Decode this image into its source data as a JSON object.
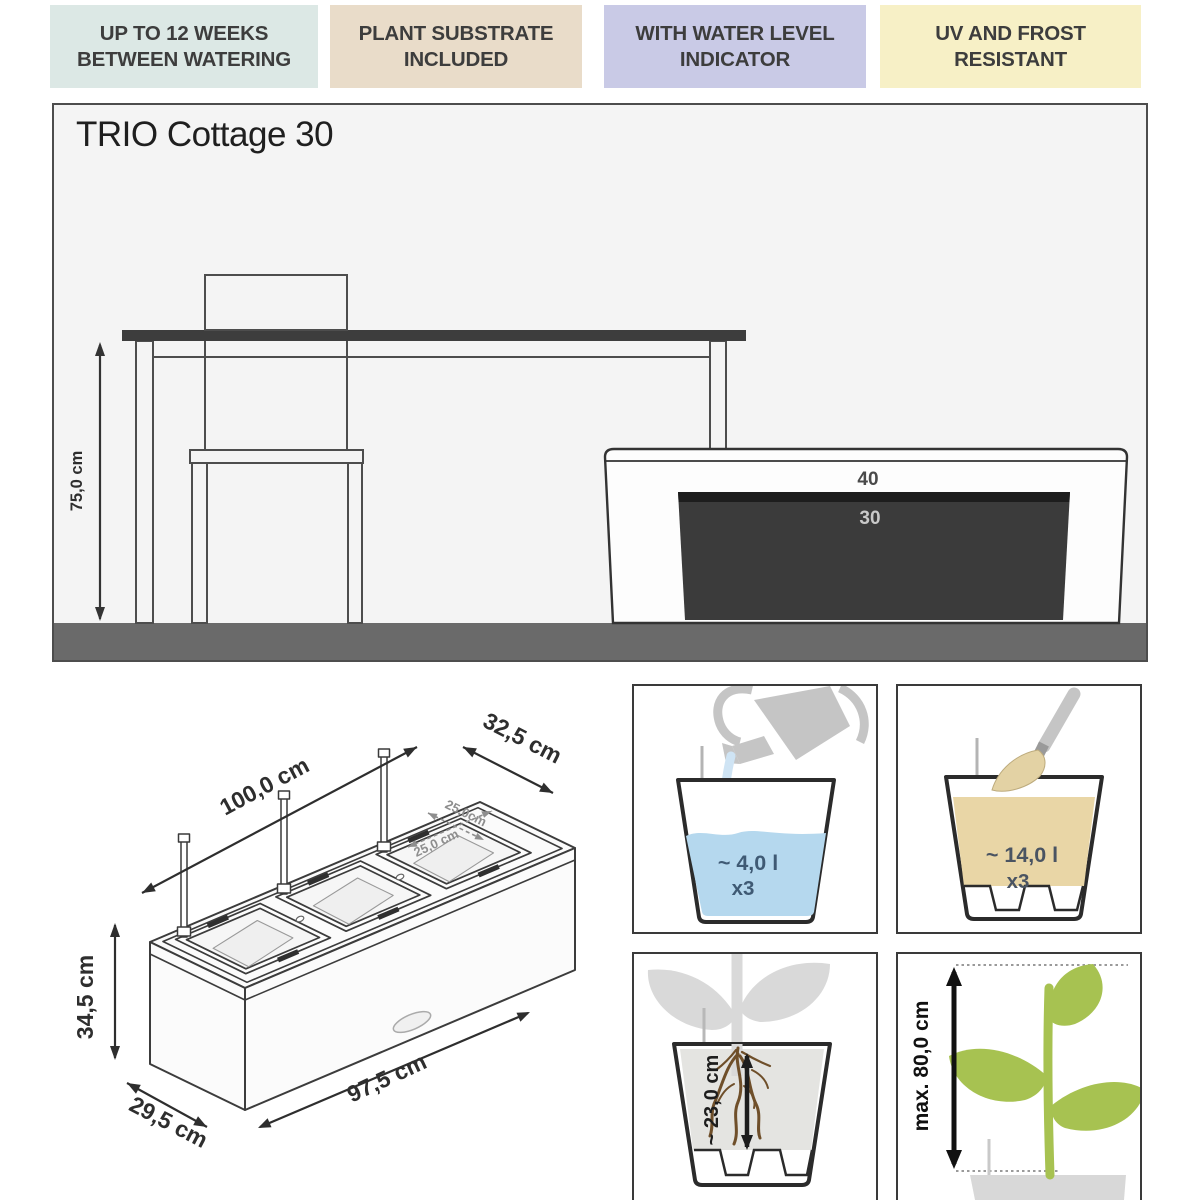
{
  "banners": [
    {
      "line1": "UP TO 12 WEEKS",
      "line2": "BETWEEN WATERING"
    },
    {
      "line1": "PLANT SUBSTRATE",
      "line2": "INCLUDED"
    },
    {
      "line1": "WITH WATER LEVEL",
      "line2": "INDICATOR"
    },
    {
      "line1": "UV AND FROST",
      "line2": "RESISTANT"
    }
  ],
  "main_diagram": {
    "title": "TRIO Cottage 30",
    "table_height_label": "75,0 cm",
    "outer_planter_label": "40",
    "inner_planter_label": "30"
  },
  "dimensions_drawing": {
    "length_top": "100,0 cm",
    "width_top": "32,5 cm",
    "inner_length": "25,0 cm",
    "inner_width": "25,0cm",
    "height": "34,5 cm",
    "length_bottom": "97,5 cm",
    "width_bottom": "29,5 cm"
  },
  "info_panels": {
    "water": {
      "volume": "~ 4,0 l",
      "multiplier": "x3"
    },
    "substrate": {
      "volume": "~ 14,0 l",
      "multiplier": "x3"
    },
    "root_depth": {
      "label": "~ 23,0 cm"
    },
    "plant_height": {
      "label": "max. 80,0 cm"
    }
  },
  "colors": {
    "banner_watering": "#dce8e5",
    "banner_substrate": "#e9dcc9",
    "banner_indicator": "#c9cae6",
    "banner_uv": "#f7f0c6",
    "water_blue": "#b5d8ee",
    "substrate_beige": "#e9d6a6",
    "leaf_green": "#a7c251",
    "root_brown": "#6f4f2a",
    "floor_gray": "#6a6a6a",
    "dark_planter": "#3b3b3b"
  }
}
